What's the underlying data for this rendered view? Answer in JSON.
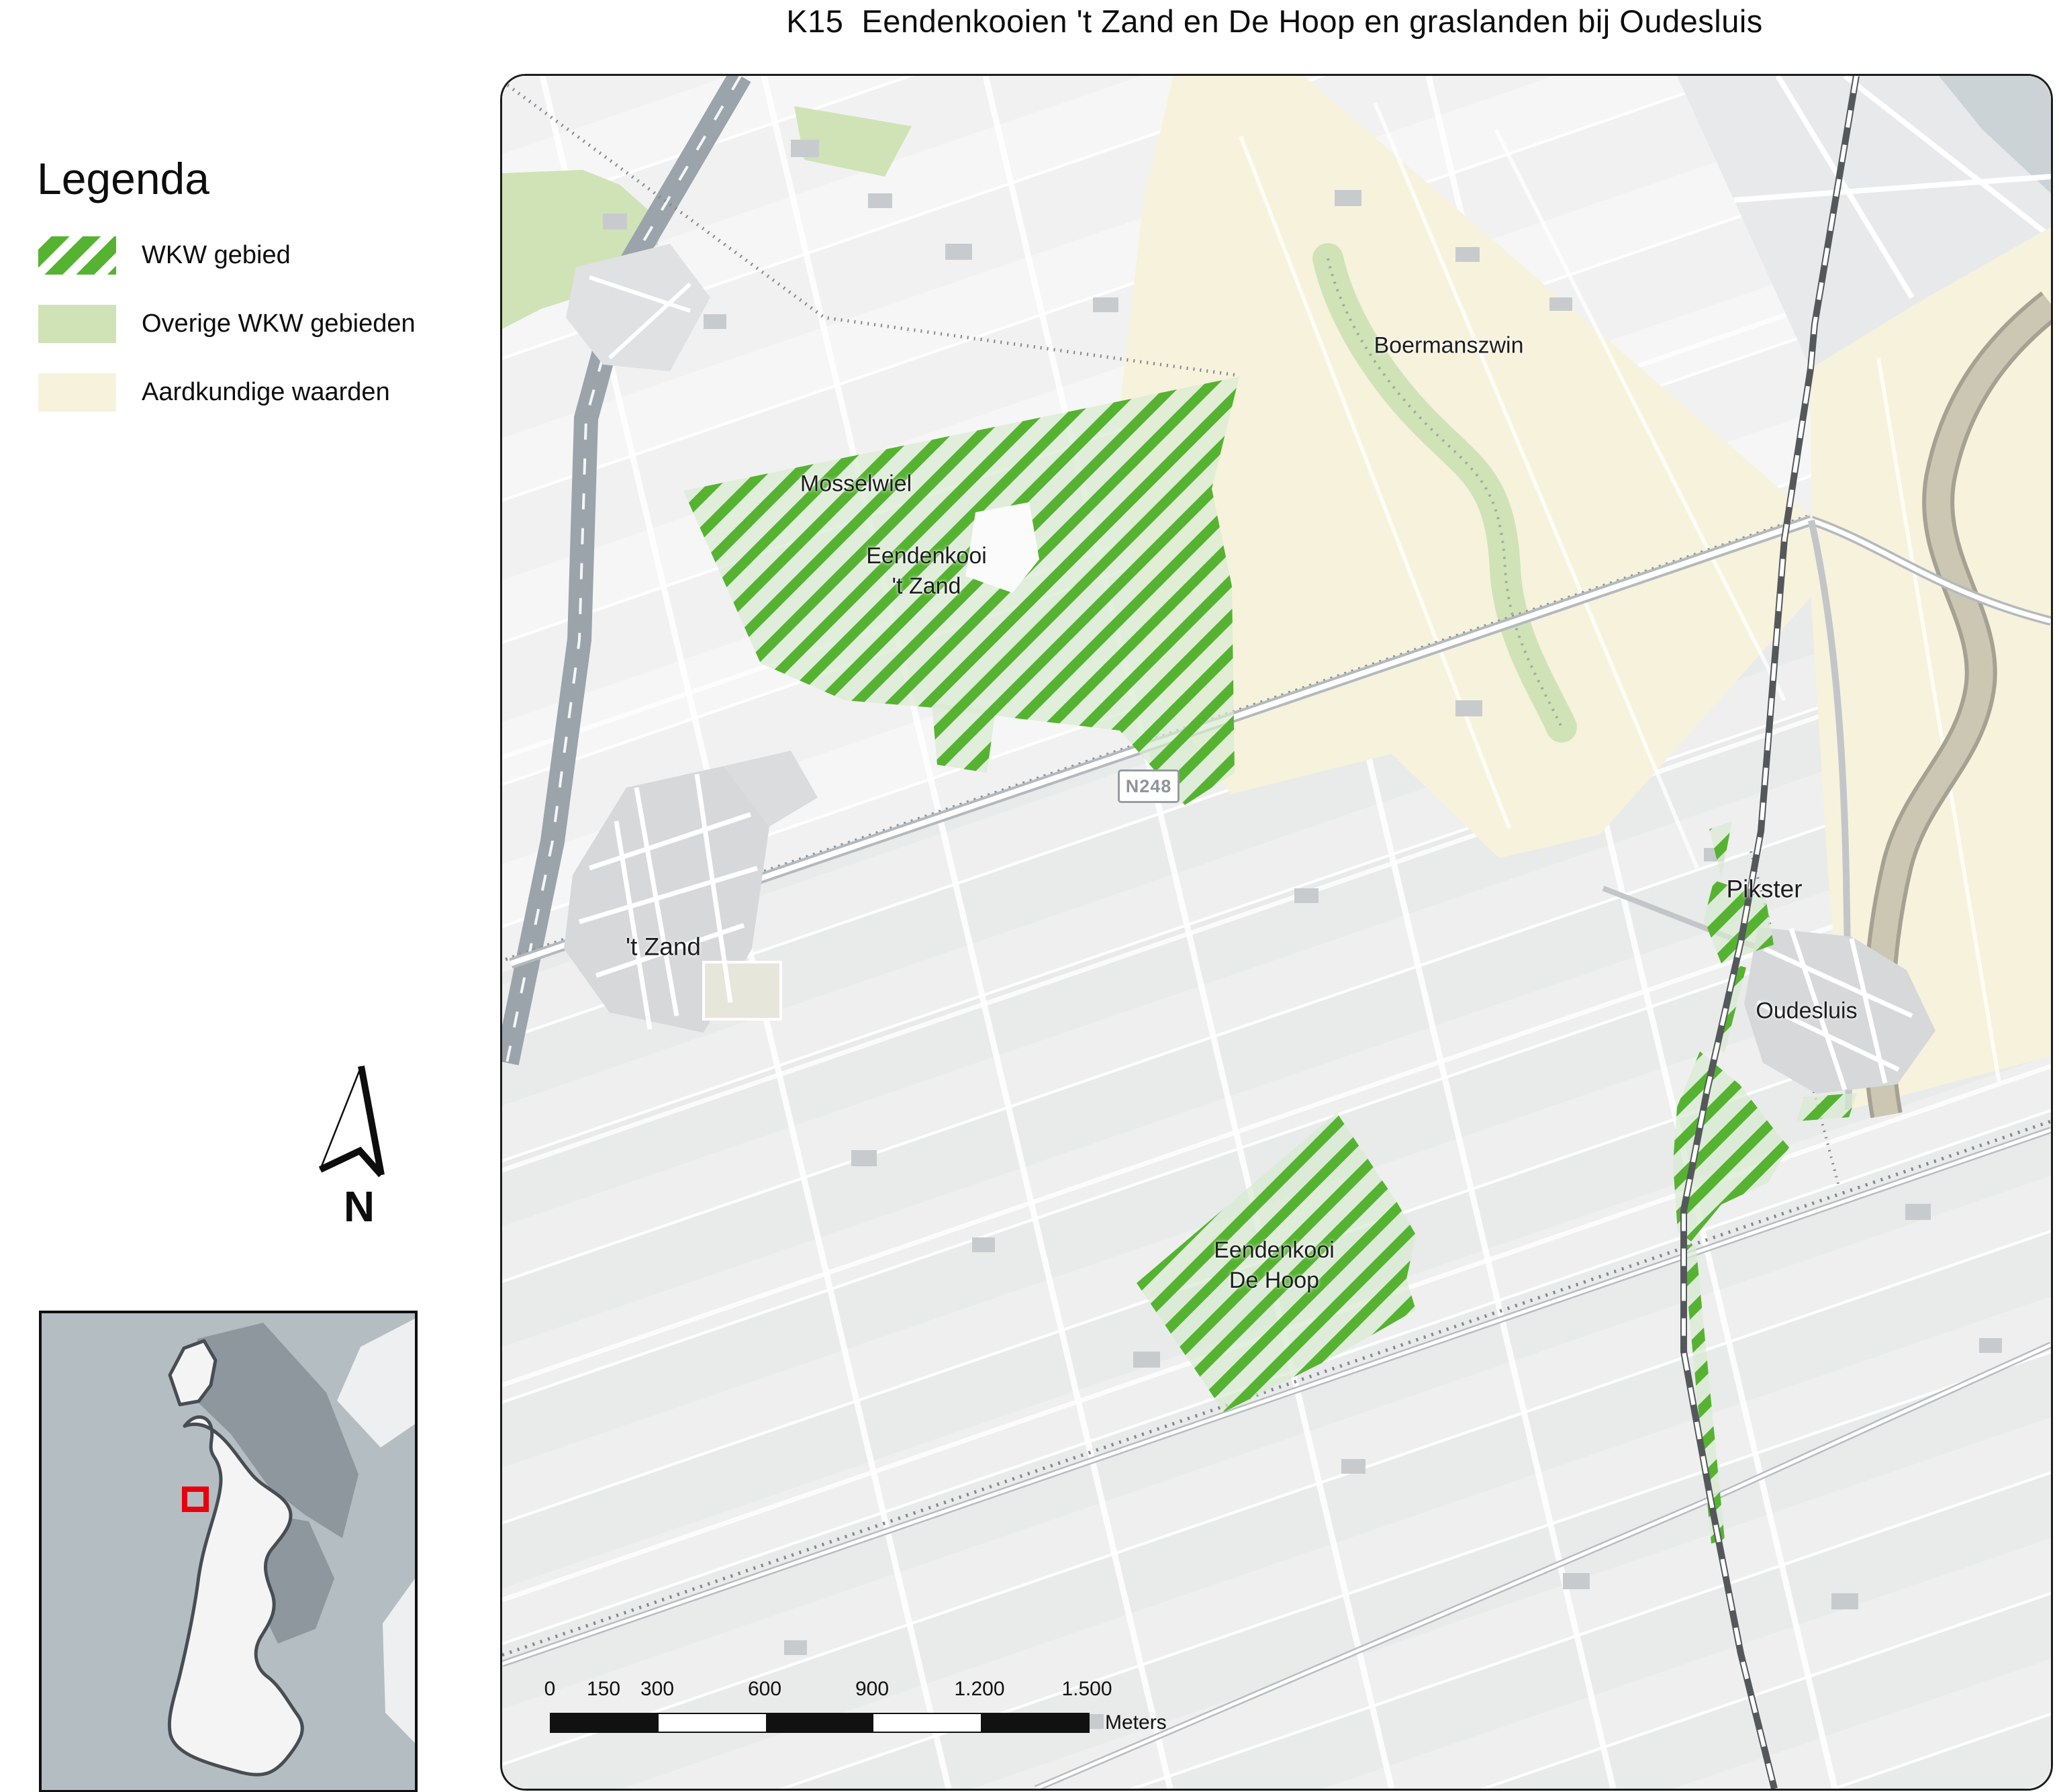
{
  "title": "K15  Eendenkooien 't Zand en De Hoop en graslanden bij Oudesluis",
  "legend": {
    "heading": "Legenda",
    "items": [
      {
        "label": "WKW gebied",
        "swatch": "green-diagonal-hatch"
      },
      {
        "label": "Overige WKW gebieden",
        "swatch": "light-green-fill"
      },
      {
        "label": "Aardkundige waarden",
        "swatch": "pale-yellow-fill"
      }
    ]
  },
  "north": {
    "label": "N"
  },
  "map": {
    "labels": {
      "mosselwiel": "Mosselwiel",
      "kooi_tzand_line1": "Eendenkooi",
      "kooi_tzand_line2": "'t Zand",
      "boermanszwin": "Boermanszwin",
      "tzand_village": "'t Zand",
      "pikster": "Pikster",
      "oudesluis": "Oudesluis",
      "dehoop_line1": "Eendenkooi",
      "dehoop_line2": "De Hoop",
      "road_shield": "N248"
    }
  },
  "scalebar": {
    "ticks": [
      "0",
      "150",
      "300",
      "600",
      "900",
      "1.200",
      "1.500"
    ],
    "unit": "Meters"
  },
  "colors": {
    "wkw_green": "#55b331",
    "wkw_light": "#d8ebd1",
    "overig_green": "#cfe3b7",
    "aard_yellow": "#f7f2dc",
    "extent_red": "#e8000d"
  }
}
